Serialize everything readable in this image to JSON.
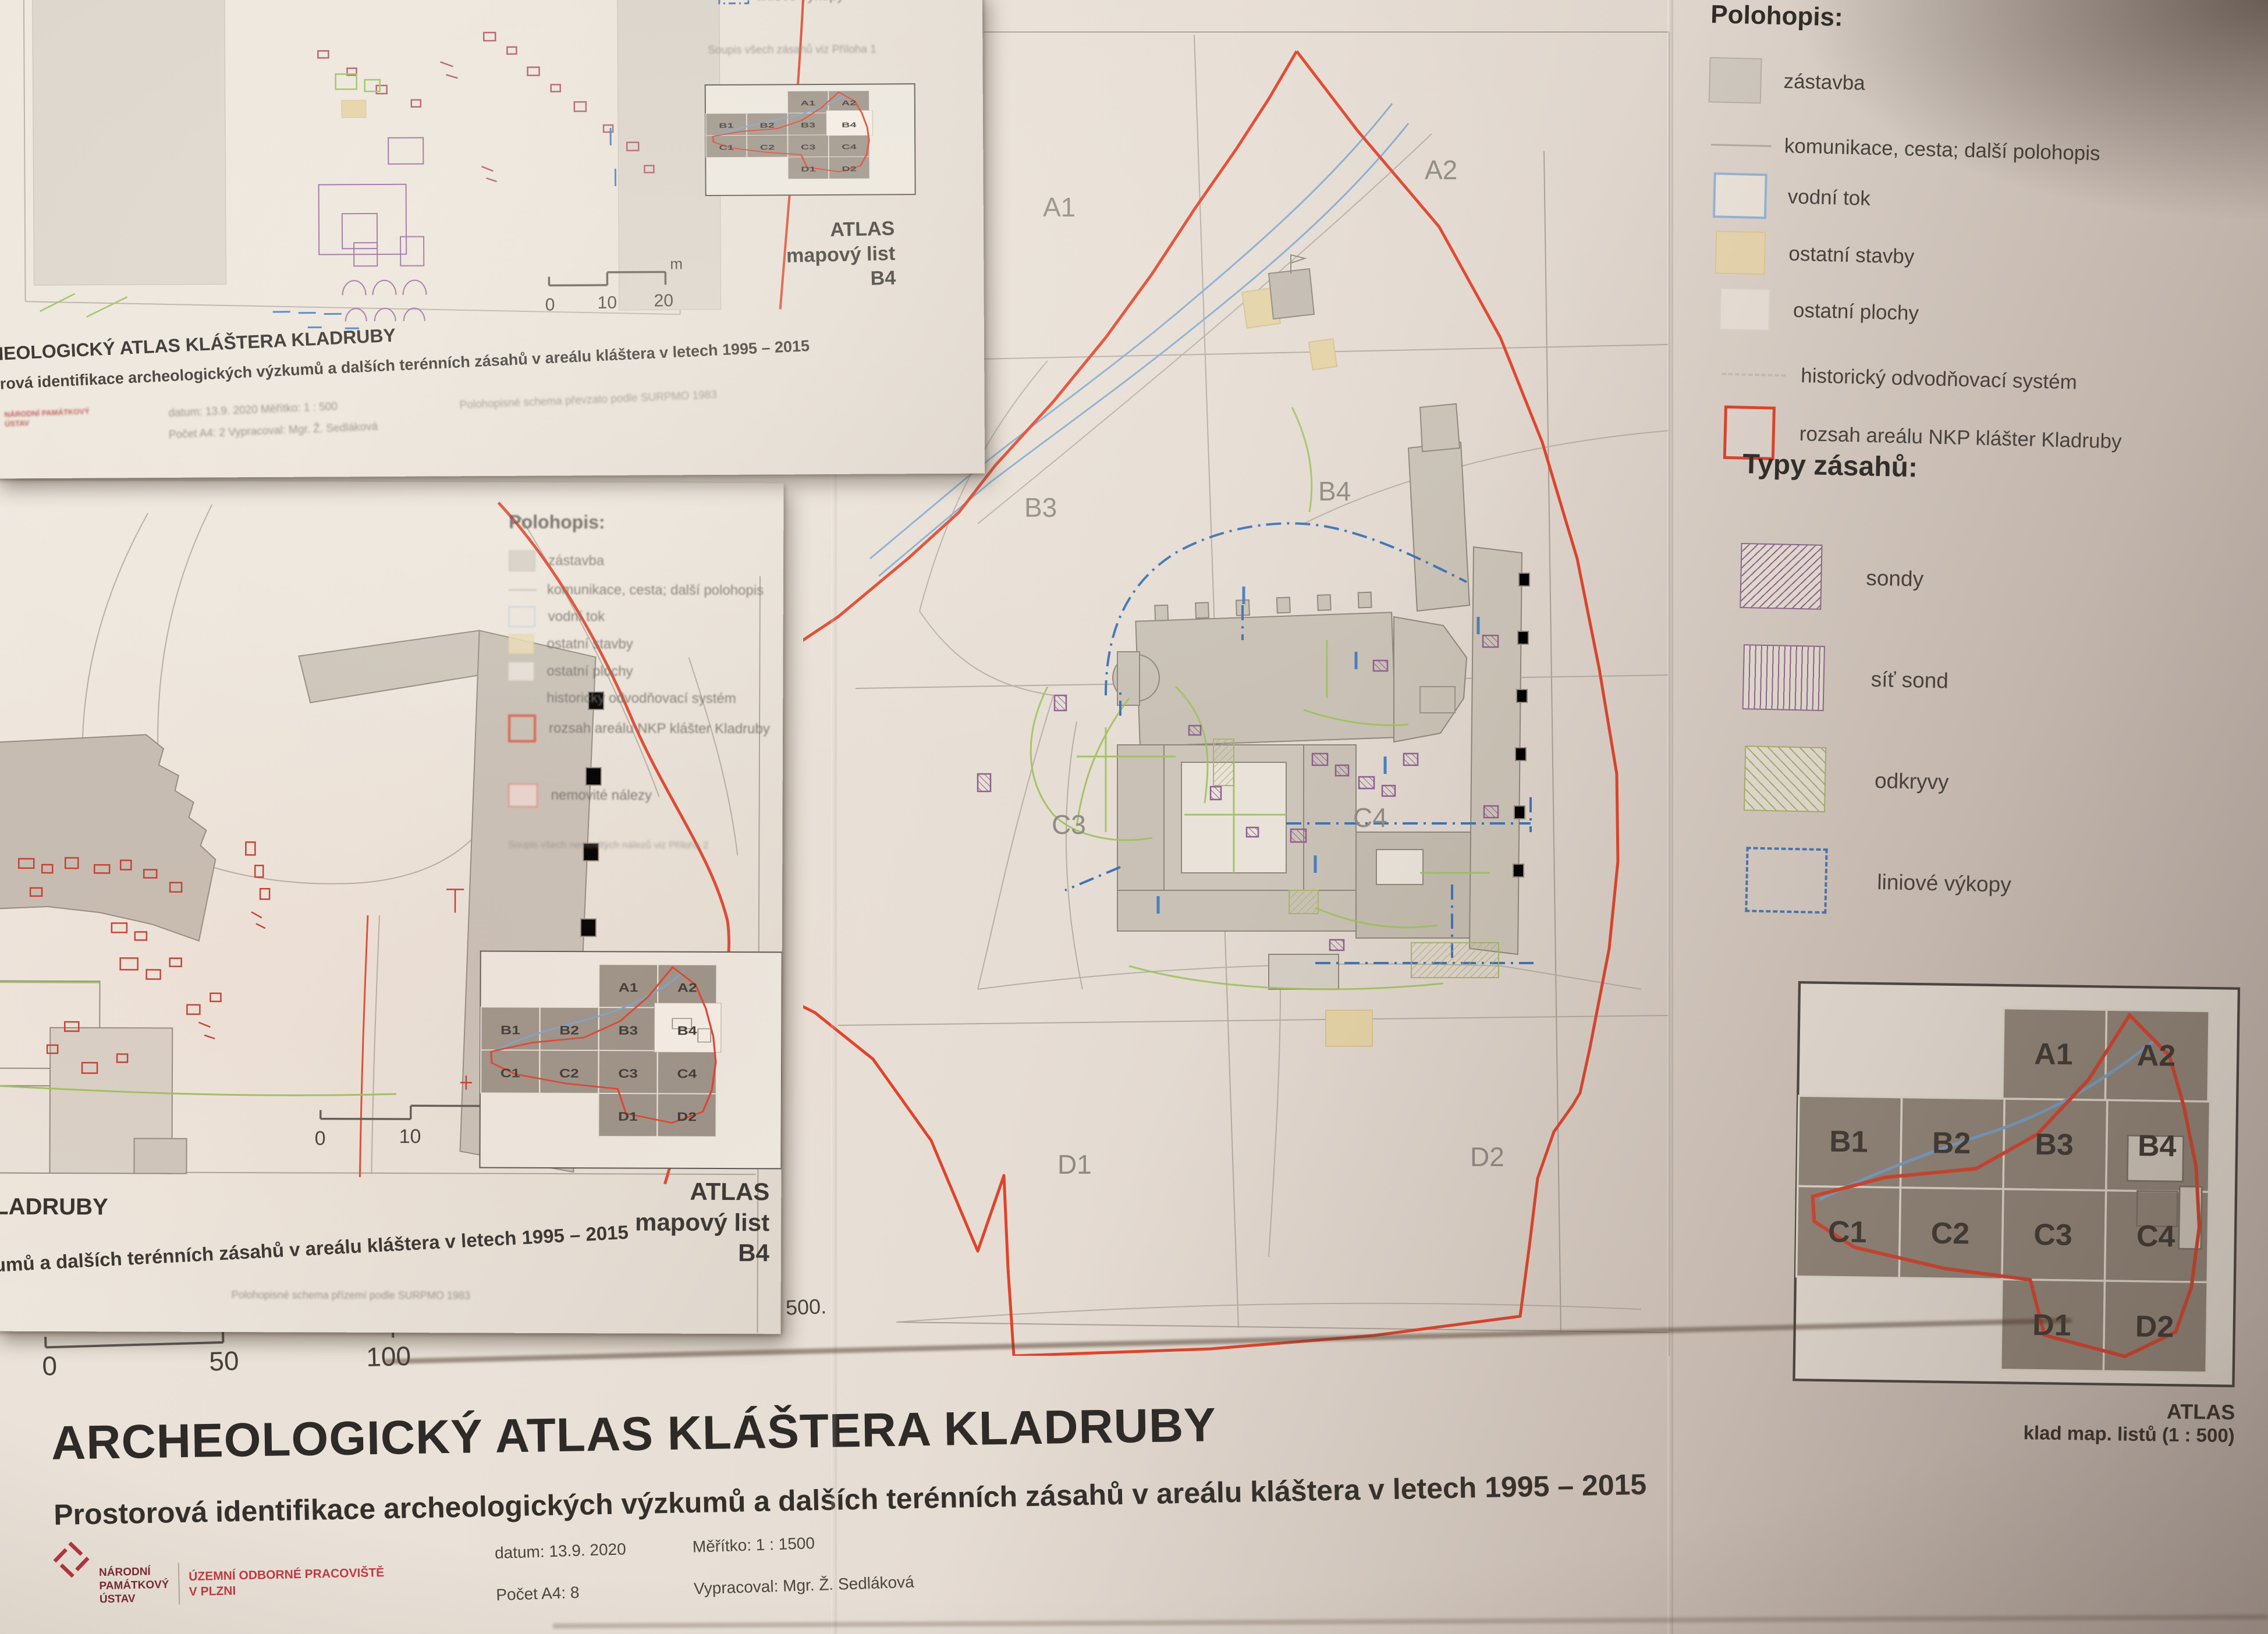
{
  "base_sheet": {
    "legend_polohopis": {
      "title": "Polohopis:",
      "items": [
        {
          "label": "zástavba",
          "swatch": "gray-fill"
        },
        {
          "label": "komunikace, cesta; další polohopis",
          "swatch": "thin-line"
        },
        {
          "label": "vodní tok",
          "swatch": "blue-outline"
        },
        {
          "label": "ostatní stavby",
          "swatch": "tan-fill"
        },
        {
          "label": "ostatní plochy",
          "swatch": "white-fill"
        },
        {
          "label": "historický odvodňovací systém",
          "swatch": "dashed-line"
        },
        {
          "label": "rozsah areálu NKP klášter Kladruby",
          "swatch": "red-outline"
        }
      ]
    },
    "legend_types": {
      "title": "Typy zásahů:",
      "items": [
        {
          "label": "sondy",
          "swatch": "hatch-backslash"
        },
        {
          "label": "síť sond",
          "swatch": "hatch-vertical"
        },
        {
          "label": "odkryvy",
          "swatch": "hatch-slash"
        },
        {
          "label": "liniové výkopy",
          "swatch": "dashdot-outline"
        }
      ]
    },
    "center_map": {
      "labels": {
        "a1": "A1",
        "a2": "A2",
        "b3": "B3",
        "b4": "B4",
        "c3": "C3",
        "c4": "C4",
        "d1": "D1",
        "d2": "D2"
      }
    },
    "index_map": {
      "labels": [
        "A1",
        "A2",
        "B1",
        "B2",
        "B3",
        "B4",
        "C1",
        "C2",
        "C3",
        "C4",
        "D1",
        "D2"
      ],
      "caption_line1": "ATLAS",
      "caption_line2": "klad map. listů (1 : 500)"
    },
    "scale_bar": {
      "t0": "0",
      "t50": "50",
      "t100": "100",
      "unit": "m"
    },
    "map_caption": "Celková situace - klad mapových listů 1 : 500.",
    "title": "ARCHEOLOGICKÝ ATLAS  KLÁŠTERA KLADRUBY",
    "subtitle": "Prostorová identifikace archeologických výzkumů a dalších terénních zásahů v areálu kláštera v letech 1995 – 2015",
    "logo": {
      "line1": "NÁRODNÍ",
      "line2": "PAMÁTKOVÝ",
      "line3": "ÚSTAV",
      "dept1": "ÚZEMNÍ ODBORNÉ PRACOVIŠTĚ",
      "dept2": "V PLZNI"
    },
    "info": {
      "datum": "datum: 13.9. 2020",
      "pocet": "Počet A4: 8",
      "meritko": "Měřítko: 1 : 1500",
      "vypracoval": "Vypracoval: Mgr. Ž. Sedláková"
    }
  },
  "sheet_a": {
    "title_fragment": "HEOLOGICKÝ ATLAS  KLÁŠTERA KLADRUBY",
    "subtitle_fragment": "orová identifikace archeologických výzkumů a dalších terénních zásahů v areálu kláštera v letech 1995 – 2015",
    "legend_fragment_label": "liniové výkopy",
    "note": "Soupis všech zásahů viz Příloha 1",
    "atlas_line1": "ATLAS",
    "atlas_line2": "mapový list",
    "atlas_line3": "B4",
    "scale": {
      "t0": "0",
      "t10": "10",
      "t20": "20",
      "unit": "m"
    },
    "meta_row1": "datum: 13.9. 2020      Měřítko: 1 : 500",
    "meta_row2": "Počet A4: 2      Vypracoval: Mgr. Ž. Sedláková",
    "meta_note": "Polohopisné schema převzato podle SURPMO 1983",
    "logo_text": "NÁRODNÍ PAMÁTKOVÝ ÚSTAV"
  },
  "sheet_b": {
    "legend_title": "Polohopis:",
    "extra_item": "nemovité nálezy",
    "note": "Soupis všech nemovitých nálezů viz Příloha 2",
    "title_fragment": "LADRUBY",
    "subtitle_fragment": "umů a dalších terénních zásahů v areálu kláštera v letech 1995 – 2015",
    "atlas_line1": "ATLAS",
    "atlas_line2": "mapový list",
    "atlas_line3": "B4",
    "scale": {
      "t0": "0",
      "t10": "10",
      "t20": "20",
      "unit": "m"
    },
    "meta_note": "Polohopisné schema přízemí podle SURPMO 1983"
  },
  "colors": {
    "boundary_red": "#df442b",
    "water_blue": "#86abd0",
    "liniove_blue": "#3f74b4",
    "odkryv_green": "#9cc25c",
    "sonda_purple": "#8d5f90",
    "building_gray": "#c9c1b5",
    "other_building_tan": "#e4d2a6",
    "logo_red": "#b5343c",
    "paper": "#e9e1d8"
  }
}
